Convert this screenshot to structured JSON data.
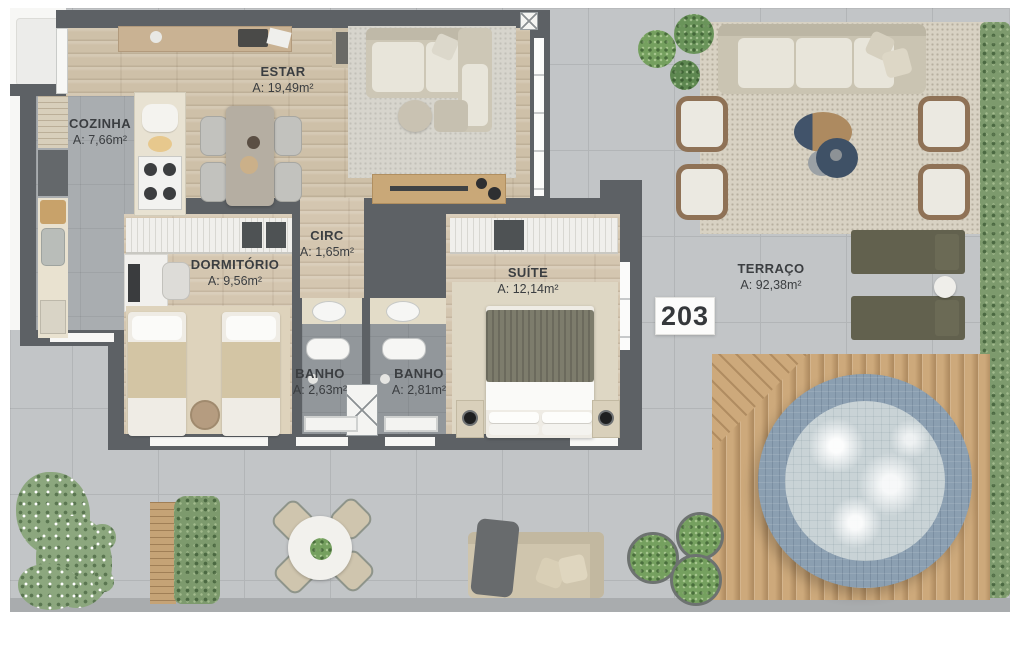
{
  "plan": {
    "unit_number": "203"
  },
  "rooms": {
    "estar": {
      "name": "ESTAR",
      "area": "A: 19,49m²"
    },
    "cozinha": {
      "name": "COZINHA",
      "area": "A: 7,66m²"
    },
    "dormitorio": {
      "name": "DORMITÓRIO",
      "area": "A: 9,56m²"
    },
    "circ": {
      "name": "CIRC",
      "area": "A: 1,65m²"
    },
    "suite": {
      "name": "SUÍTE",
      "area": "A: 12,14m²"
    },
    "banho1": {
      "name": "BANHO",
      "area": "A: 2,63m²"
    },
    "banho2": {
      "name": "BANHO",
      "area": "A: 2,81m²"
    },
    "terraco": {
      "name": "TERRAÇO",
      "area": "A: 92,38m²"
    }
  },
  "colors": {
    "wall": "#5d6165",
    "wood": "#cec0a8",
    "wood2": "#d4c6b0",
    "tile": "#c2c5c7",
    "tileLine": "#b2b5b7",
    "kfloor": "#a9adb0",
    "bfloor": "#92979b",
    "deck": "#cda97b",
    "poolRing": "#8b9fb1",
    "water": "#c9d3d6",
    "hedge": "#7d9a6d",
    "lounger": "#62614e",
    "rugBeige": "#ded5c0",
    "speckRug": "#d8d2c3",
    "ink": "#3b3e41"
  }
}
